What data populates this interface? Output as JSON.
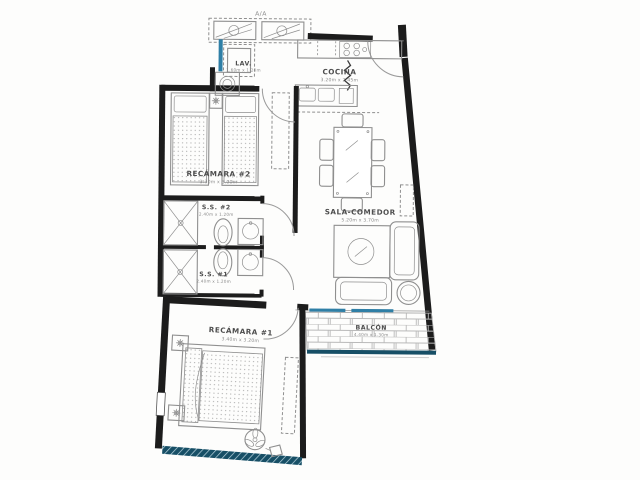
{
  "plan": {
    "type": "apartment-floor-plan",
    "aa_label": "A/A",
    "rooms": {
      "lav": {
        "label": "LAV.",
        "dims": "1.60m x 1.20m"
      },
      "cocina": {
        "label": "COCINA",
        "dims": "3.20m x 2.45m"
      },
      "recamara2": {
        "label": "RECÁMARA #2",
        "dims": "3.30m x 3.00m"
      },
      "ss2": {
        "label": "S.S. #2",
        "dims": "2.40m x 1.20m"
      },
      "ss1": {
        "label": "S.S. #1",
        "dims": "2.40m x 1.20m"
      },
      "sala": {
        "label": "SALA-COMEDOR",
        "dims": "5.20m x 3.70m"
      },
      "recamara1": {
        "label": "RECÁMARA #1",
        "dims": "3.40m x 3.20m"
      },
      "balcon": {
        "label": "BALCÓN",
        "dims": "4.40m x 1.30m"
      }
    }
  },
  "colors": {
    "wall": "#1c1c1c",
    "accent": "#2f7fa6",
    "accentdark": "#174f66",
    "line": "#8f8f8f",
    "labeltext": "#4d4d4d",
    "dimtext": "#8a8a8a",
    "brickline": "#b9b9b9",
    "dotfill": "#9b9b9b",
    "paper": "#fdfdfc"
  }
}
